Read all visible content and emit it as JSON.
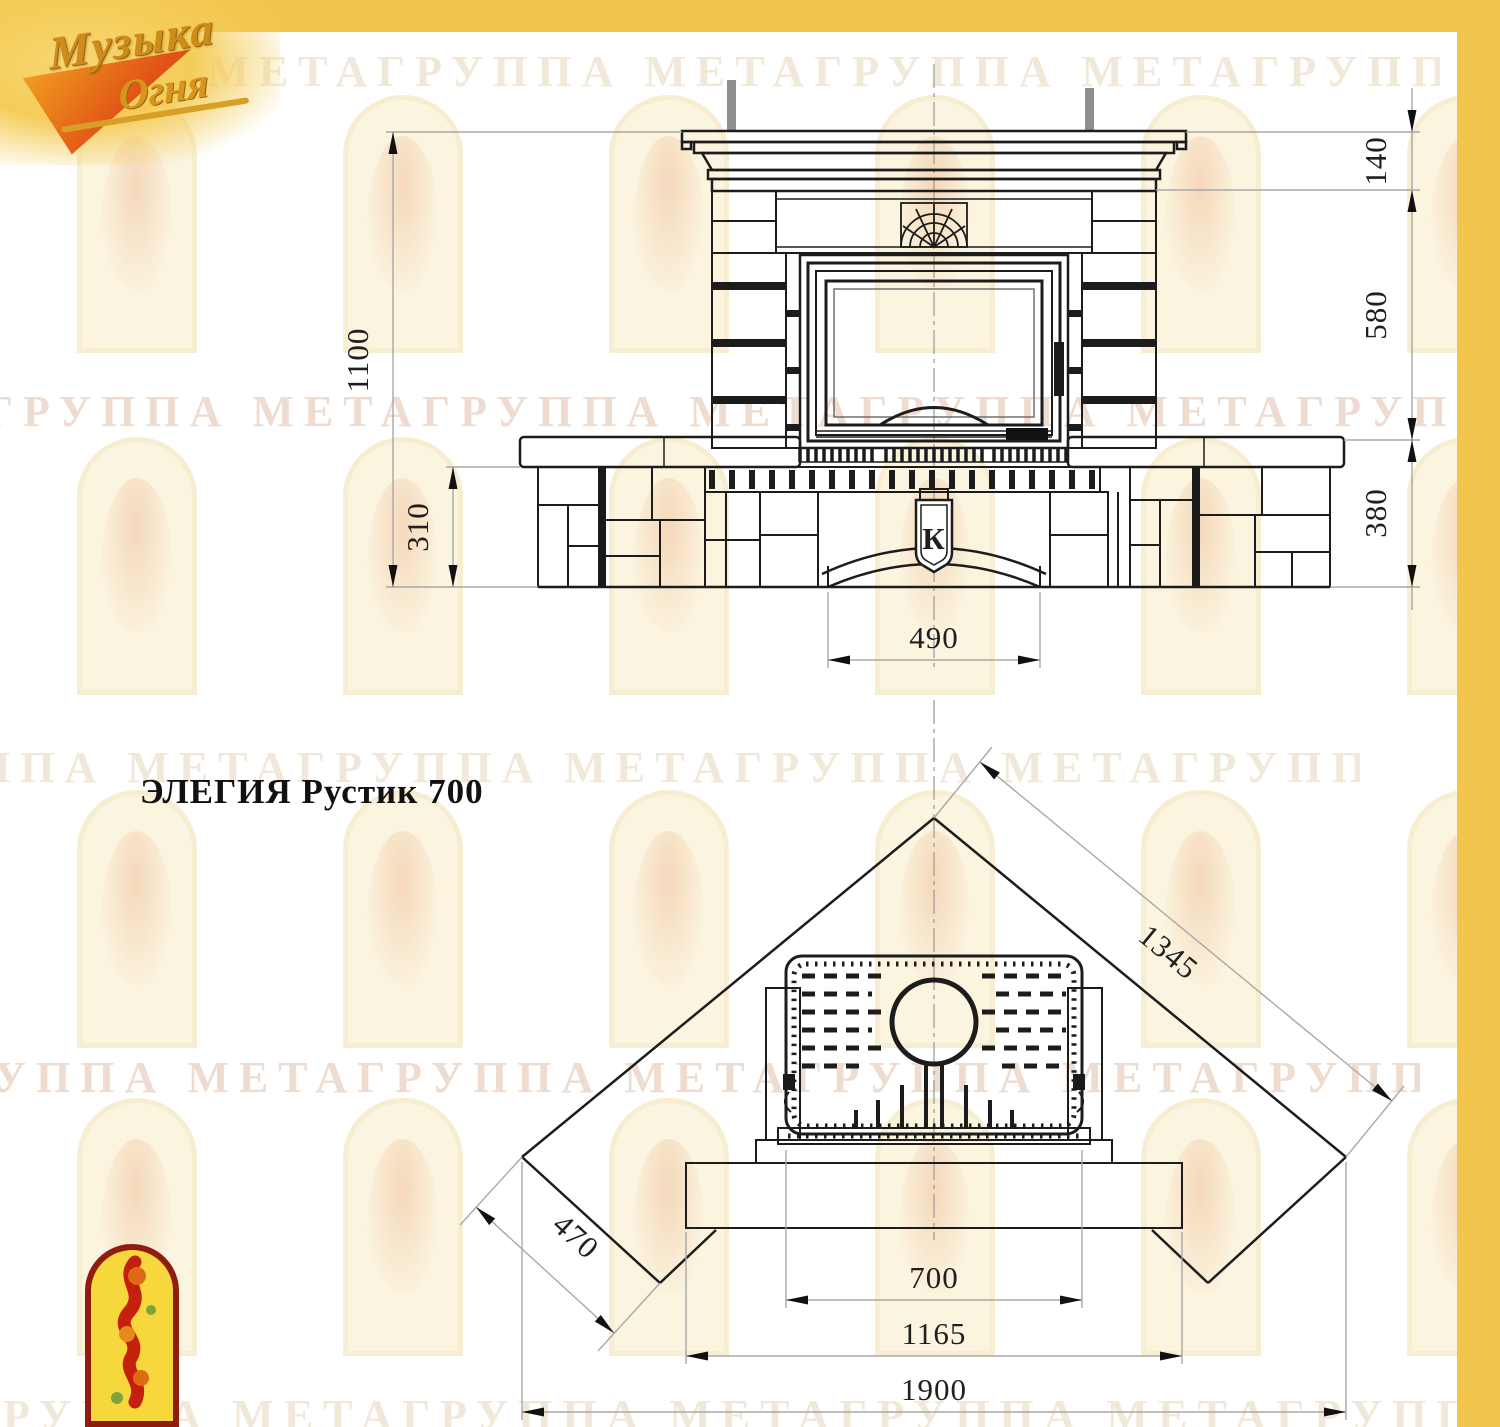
{
  "page": {
    "background": "#ffffff",
    "frame_color": "#F2C64C"
  },
  "brand_logo": {
    "word1": "Музыка",
    "word2": "Огня"
  },
  "title": "ЭЛЕГИЯ Рустик 700",
  "watermark": {
    "text": "ГРУППА МЕТАГРУППА МЕТАГРУППА МЕТАГРУППА МЕТАГРУППА МЕТАГРУППА МЕТАГРУППА МЕТАГРУППА"
  },
  "front_view": {
    "label": "front elevation",
    "emblem_letter": "К",
    "dims": {
      "total_height": "1100",
      "plinth_height": "310",
      "opening_width": "490",
      "crown_height": "140",
      "body_height": "580",
      "base_height": "380"
    }
  },
  "plan_view": {
    "label": "plan view",
    "dims": {
      "back_diagonal": "1345",
      "corner_depth": "470",
      "firebox_width": "700",
      "hearth_width": "1165",
      "overall_width": "1900"
    }
  }
}
